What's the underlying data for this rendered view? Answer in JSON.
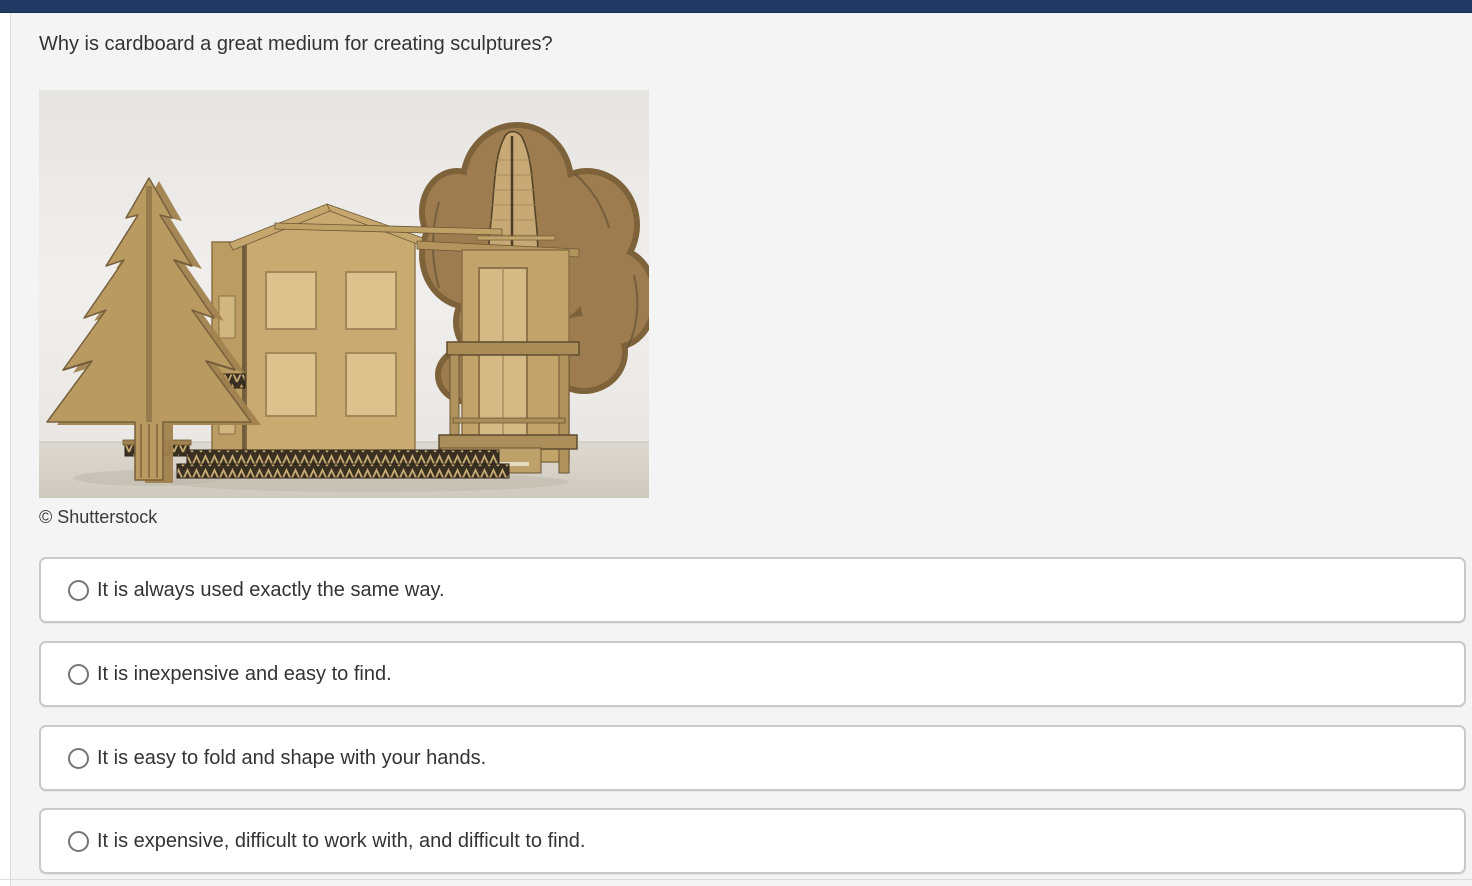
{
  "header": {
    "bar_color": "#203a64"
  },
  "question": {
    "text": "Why is cardboard a great medium for creating sculptures?"
  },
  "figure": {
    "credit": "© Shutterstock",
    "alt": "Cardboard sculpture of a two-story house with a pine tree and an oak tree"
  },
  "options": [
    {
      "label": "It is always used exactly the same way.",
      "selected": false
    },
    {
      "label": "It is inexpensive and easy to find.",
      "selected": false
    },
    {
      "label": "It is easy to fold and shape with your hands.",
      "selected": false
    },
    {
      "label": "It is expensive, difficult to work with, and difficult to find.",
      "selected": false
    }
  ],
  "colors": {
    "top_bar": "#203a64",
    "panel_bg": "#f4f4f4",
    "option_border": "#c9c9c9",
    "option_bg": "#ffffff",
    "text": "#333333",
    "cardboard": "#c9aa70",
    "cardboard_light": "#ddc28e",
    "cardboard_dark": "#8a7046",
    "photo_bg": "#eae8e5"
  }
}
